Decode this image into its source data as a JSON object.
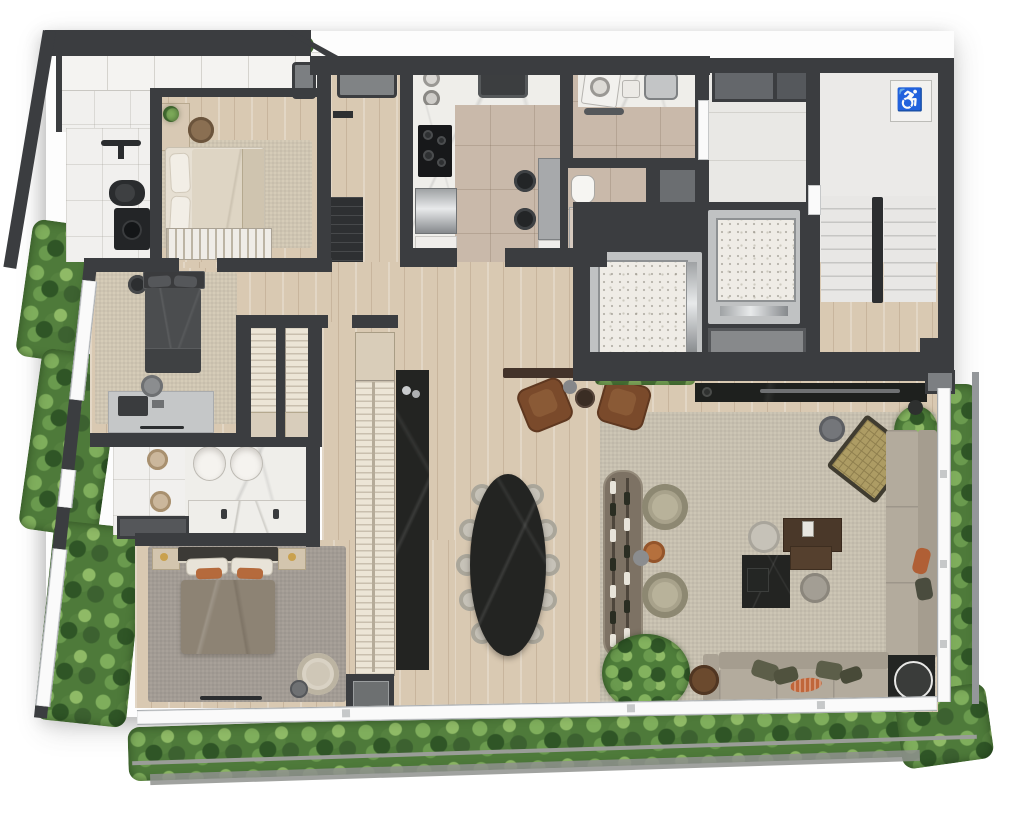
{
  "meta": {
    "title": "Apartment floor plan — furnished top-view rendering",
    "canvas_width": 1024,
    "canvas_height": 822,
    "visible_text": "none (graphic plan only)"
  },
  "palette": {
    "wall": "#3b3d40",
    "wood": "#d9c9b2",
    "tile": "#c9b9aa",
    "white": "#f1f0ee",
    "marbleDark": "#232422",
    "elevatorFloor": "#efece6",
    "stairFloor": "#ebeae8",
    "rugLiving": "#cdc6b5",
    "rugBeige": "#d6ccb8",
    "rugGray": "#a8a199",
    "sofa": "#b3ab9d",
    "chairBeige": "#a8a28b",
    "accentOrange": "#b56a3c",
    "hedge": "#4e7a3a",
    "glass": "#fafafa"
  },
  "icons": {
    "wheelchair": "♿"
  },
  "rooms": {
    "wardrobe_room": {
      "name": "Wardrobe room (top-left closets)"
    },
    "bathroom1": {
      "name": "Bathroom 1 (black fixtures)"
    },
    "bedroom1": {
      "name": "Bedroom 1 (single bed, cream)"
    },
    "hall_corridor": {
      "name": "Corridor by kitchen"
    },
    "kitchen": {
      "name": "Kitchen (cooktop, sink, island with 2 stools)"
    },
    "laundry": {
      "name": "Laundry (washer + sink)"
    },
    "bathroom2": {
      "name": "Bathroom 2 (shower, toilet, basin)"
    },
    "foyer": {
      "name": "Private foyer"
    },
    "stair_hall": {
      "name": "Stair hall with accessibility zone"
    },
    "elevators": {
      "name": "Two elevators"
    },
    "bedroom2": {
      "name": "Bedroom 2 (dark bed + desk)"
    },
    "closets": {
      "name": "Twin wardrobe closets"
    },
    "master_bathroom": {
      "name": "Master bathroom (twin basins + vanity)"
    },
    "master_bedroom": {
      "name": "Master bedroom (double bed)"
    },
    "walk_in_shelves": {
      "name": "Walk-in shelving wall"
    },
    "bar_counter": {
      "name": "Dark marble bar counter"
    },
    "dining_area": {
      "name": "Dining area (oval stone table)"
    },
    "living_room": {
      "name": "Living room (L-sofa, coffee tables)"
    },
    "terrace_garden": {
      "name": "Perimeter garden hedges"
    }
  },
  "furniture_counts": {
    "dining_chairs": 10,
    "wine_bottles": 13,
    "bar_stools": 2,
    "elevators": 2,
    "stair_steps_per_flight": 8,
    "stair_flights": 2,
    "lounge_barrel_chairs": 2,
    "brown_armchairs": 2,
    "beds": 3,
    "sofa_pillows": 6
  }
}
